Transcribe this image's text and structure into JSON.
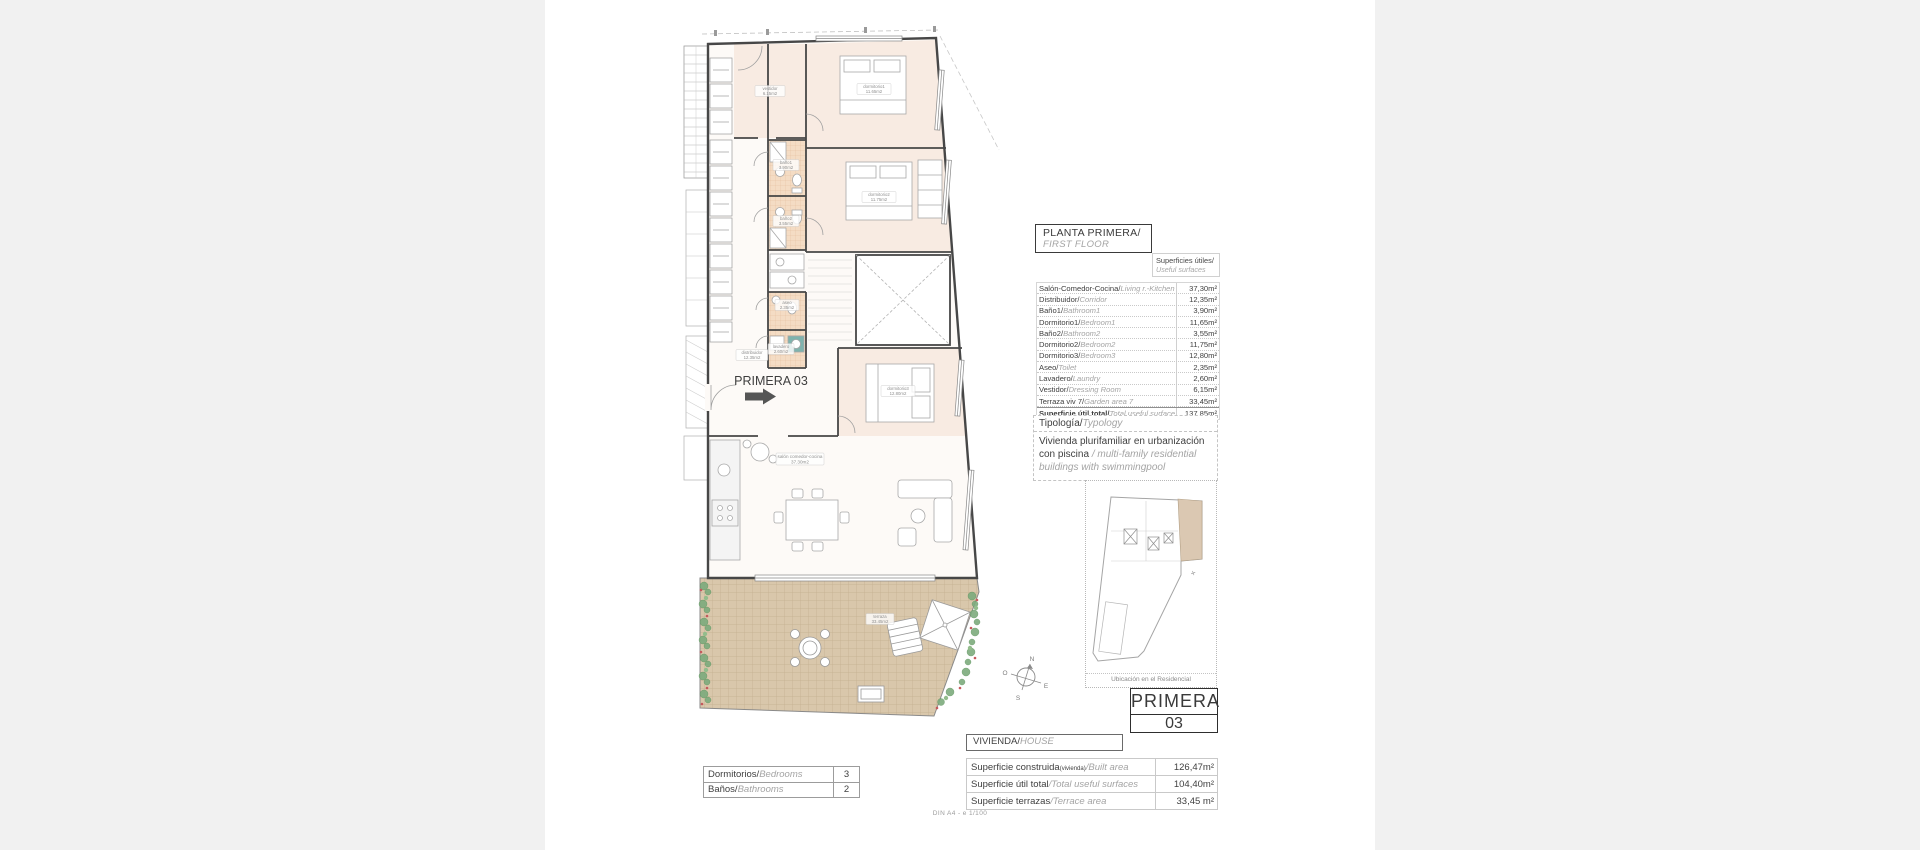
{
  "header_box": {
    "title": "PLANTA PRIMERA/",
    "subtitle": "FIRST FLOOR"
  },
  "surfaces_caption": {
    "es": "Superficies útiles/",
    "en": "Useful surfaces"
  },
  "surfaces_table": {
    "rows": [
      {
        "es": "Salón-Comedor-Cocina/",
        "en": "Living r.-Kitchen",
        "value": "37,30m²"
      },
      {
        "es": "Distribuidor/",
        "en": "Corridor",
        "value": "12,35m²"
      },
      {
        "es": "Baño1/",
        "en": "Bathroom1",
        "value": "3,90m²"
      },
      {
        "es": "Dormitorio1/",
        "en": "Bedroom1",
        "value": "11,65m²"
      },
      {
        "es": "Baño2/",
        "en": "Bathroom2",
        "value": "3,55m²"
      },
      {
        "es": "Dormitorio2/",
        "en": "Bedroom2",
        "value": "11,75m²"
      },
      {
        "es": "Dormitorio3/",
        "en": "Bedroom3",
        "value": "12,80m²"
      },
      {
        "es": "Aseo/",
        "en": "Toilet",
        "value": "2,35m²"
      },
      {
        "es": "Lavadero/",
        "en": "Laundry",
        "value": "2,60m²"
      },
      {
        "es": "Vestidor/",
        "en": "Dressing Room",
        "value": "6,15m²"
      },
      {
        "es": "Terraza viv 7/",
        "en": "Garden area 7",
        "value": "33,45m²"
      },
      {
        "es": "Superficie útil total/",
        "en": "Total useful surface",
        "value": "137,85m²"
      }
    ]
  },
  "typology": {
    "header_es": "Tipología/",
    "header_en": "Typology",
    "body_es": "Vivienda plurifamiliar en urbanización con piscina",
    "body_en": "/ multi-family residential buildings with swimmingpool"
  },
  "location_map": {
    "caption": "Ubicación en el Residencial"
  },
  "unit_box": {
    "line1": "PRIMERA",
    "line2": "03"
  },
  "vivienda_box": {
    "es": "VIVIENDA/",
    "en": "HOUSE"
  },
  "summary_table": {
    "rows": [
      {
        "es": "Superficie construida",
        "sub": "(vivienda)",
        "en": "/Built area",
        "value": "126,47m²"
      },
      {
        "es": "Superficie útil total",
        "sub": "",
        "en": "/Total useful surfaces",
        "value": "104,40m²"
      },
      {
        "es": "Superficie terrazas",
        "sub": "",
        "en": "/Terrace area",
        "value": "33,45 m²"
      }
    ]
  },
  "rooms_table": {
    "rows": [
      {
        "es": "Dormitorios/",
        "en": "Bedrooms",
        "value": "3"
      },
      {
        "es": "Baños/",
        "en": "Bathrooms",
        "value": "2"
      }
    ]
  },
  "footer": {
    "scale_note": "DIN A4 - e 1/100"
  },
  "plan": {
    "unit_label": "PRIMERA 03",
    "compass": {
      "n": "N",
      "e": "E",
      "s": "S",
      "o": "O"
    },
    "rooms": [
      {
        "name": "vestidor",
        "area": "6.15m2"
      },
      {
        "name": "dormitorio1",
        "area": "11.65m2"
      },
      {
        "name": "baño1",
        "area": "3.90m2"
      },
      {
        "name": "dormitorio2",
        "area": "11.75m2"
      },
      {
        "name": "baño2",
        "area": "3.55m2"
      },
      {
        "name": "aseo",
        "area": "2.35m2"
      },
      {
        "name": "lavadero",
        "area": "2.60m2"
      },
      {
        "name": "distribuidor",
        "area": "12.35m2"
      },
      {
        "name": "dormitorio3",
        "area": "12.80m2"
      },
      {
        "name": "salón comedor-cocina",
        "area": "37.30m2"
      },
      {
        "name": "terraza",
        "area": "33.45m2"
      }
    ]
  },
  "colors": {
    "wall": "#474747",
    "terrace_tile": "#d9c7ab",
    "bath_tile": "#f4dcc4",
    "room_tint": "#f8ebe2",
    "plant_green": "#7dab7d",
    "flower_red": "#c5595c",
    "teal_appliance": "#7fb3ad",
    "map_highlight": "#dbc8b2"
  }
}
